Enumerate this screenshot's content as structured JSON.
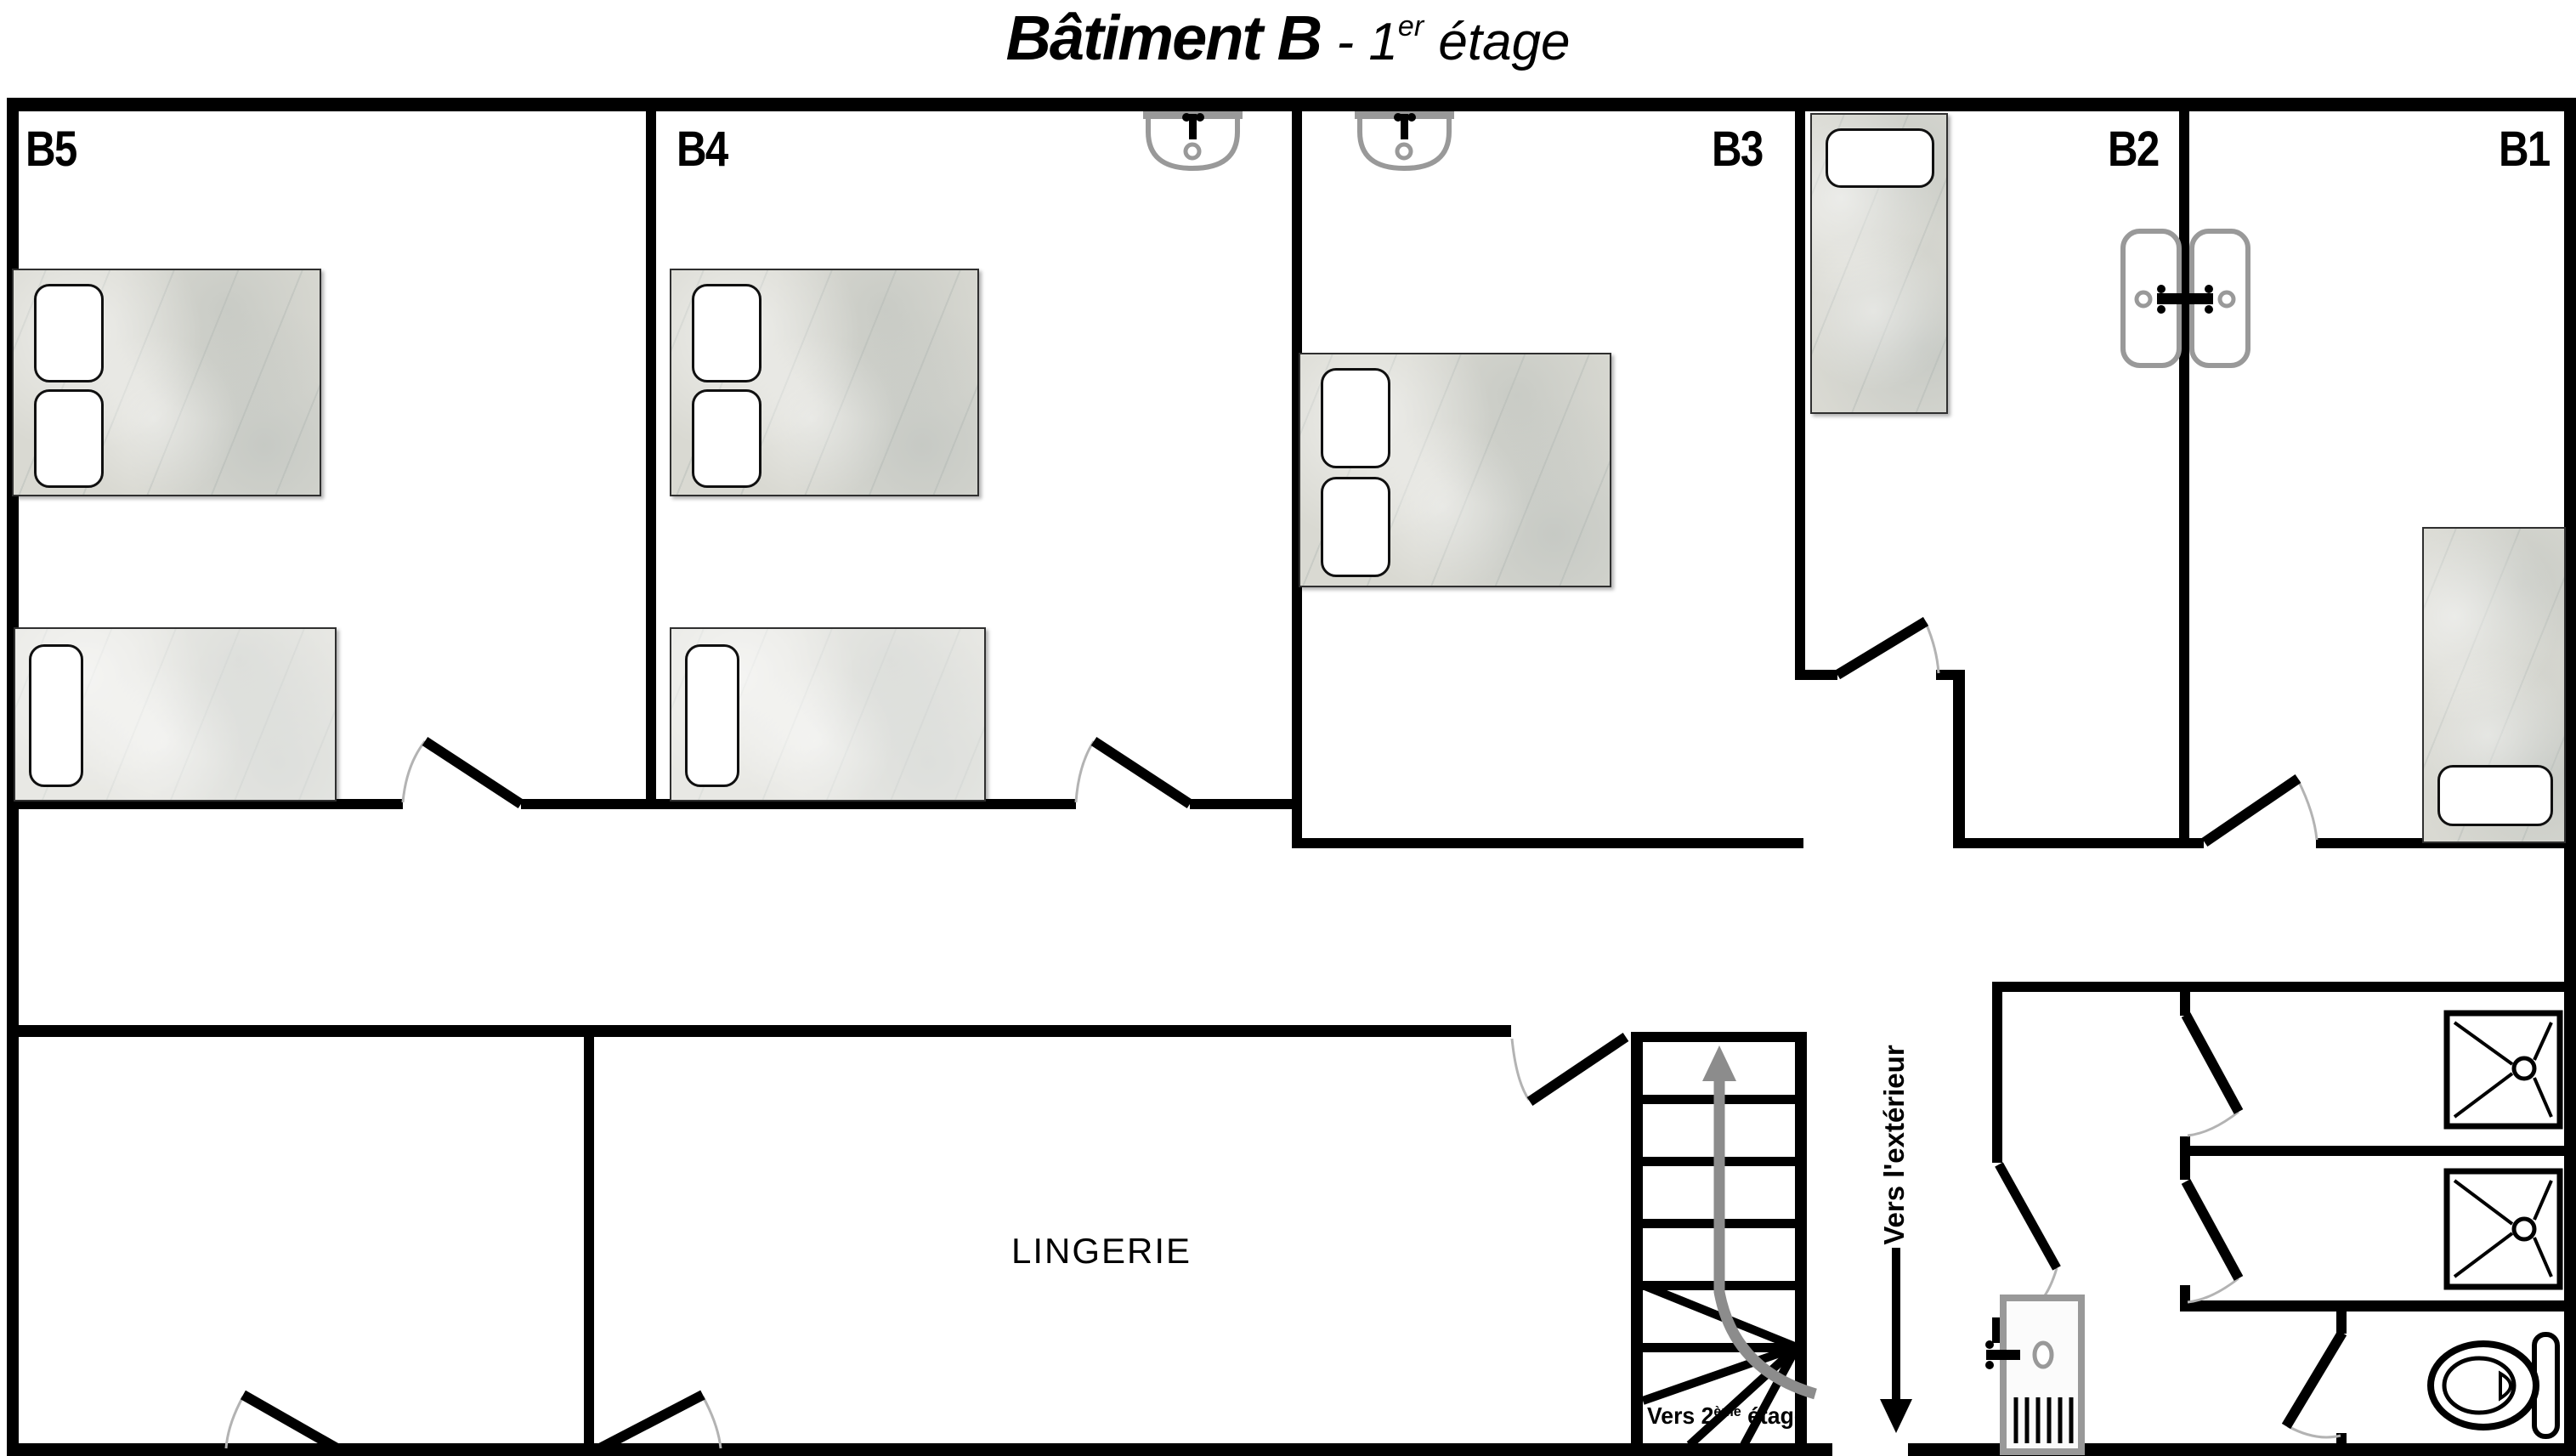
{
  "title": {
    "building": "Bâtiment B",
    "separator": "-",
    "floor_number": "1",
    "floor_ordinal_suffix": "er",
    "floor_word": "étage"
  },
  "room_labels": {
    "b5": "B5",
    "b4": "B4",
    "b3": "B3",
    "b2": "B2",
    "b1": "B1"
  },
  "areas": {
    "laundry": "LINGERIE"
  },
  "annotations": {
    "to_exterior": "Vers l'extérieur",
    "to_second_floor_prefix": "Vers 2",
    "to_second_floor_sup": "ème",
    "to_second_floor_suffix": " étage"
  },
  "icons": {
    "sink-icon": "wall-mounted washbasin with faucet and drain",
    "double-sink-icon": "back-to-back washbasins on partition wall with shared faucet",
    "double-bed-icon": "double bed with two pillows",
    "single-bed-icon": "single bed with one pillow",
    "shower-tray-icon": "square shower tray with drain",
    "toilet-icon": "toilet bowl with cistern",
    "exterior-door-icon": "exterior door panel with handle and vents",
    "stairs-up-arrow-icon": "curved arrow going up the staircase",
    "exit-arrow-icon": "straight arrow pointing outside",
    "door-swing-icon": "door leaf with swing arc"
  },
  "colors": {
    "wall": "#000000",
    "fixture_gray": "#999999",
    "arrow_gray": "#8c8c8c",
    "bed_fill": "#d9d9d2",
    "pillow": "#ffffff",
    "background": "#ffffff"
  }
}
